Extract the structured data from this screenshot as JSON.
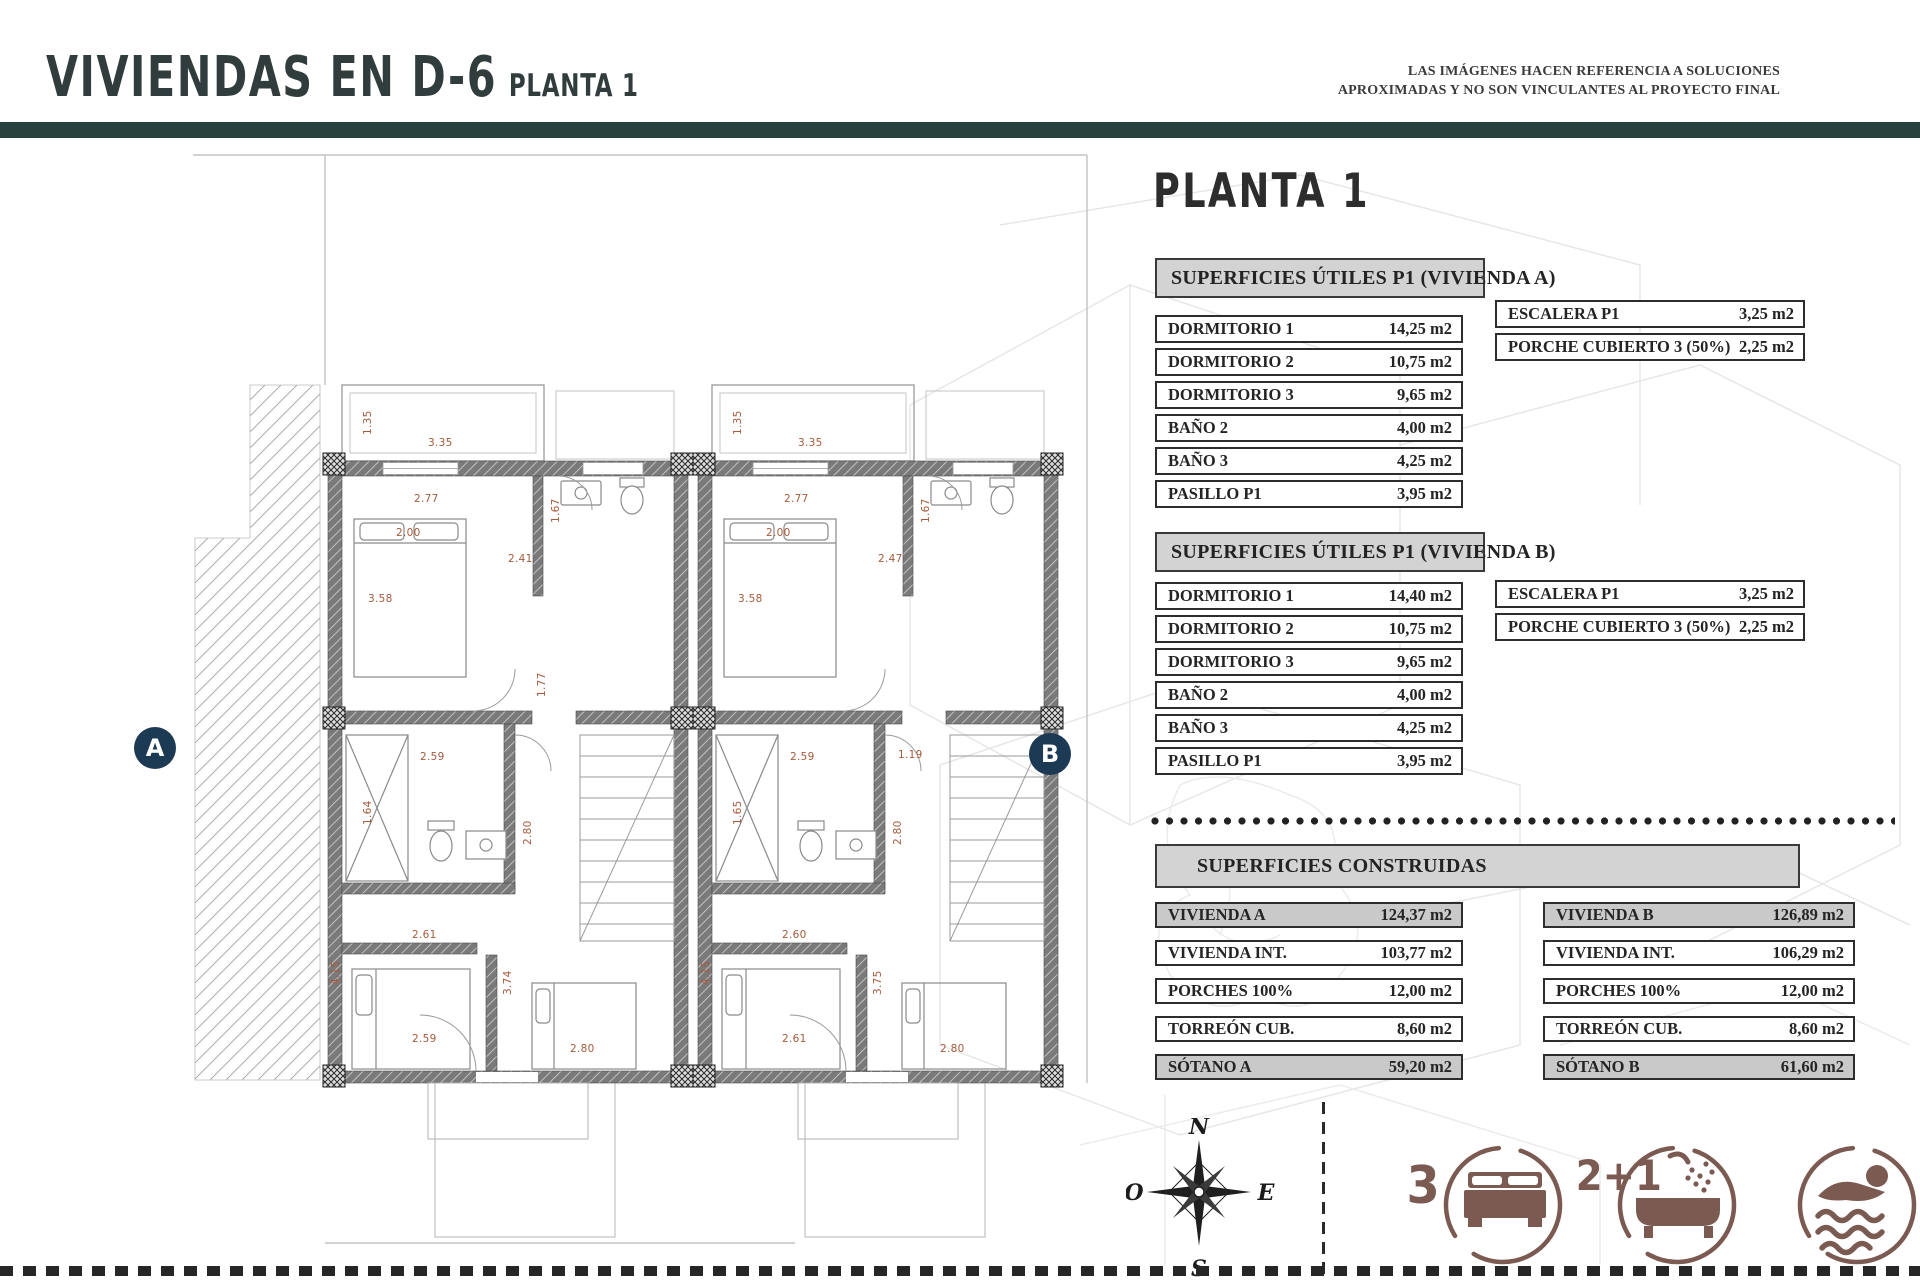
{
  "header": {
    "title": "VIVIENDAS EN D-6",
    "subtitle": "PLANTA 1",
    "disclaimer_line1": "LAS IMÁGENES HACEN REFERENCIA A SOLUCIONES",
    "disclaimer_line2": "APROXIMADAS Y NO SON VINCULANTES AL PROYECTO FINAL"
  },
  "panel": {
    "heading": "PLANTA 1",
    "utiles_a": {
      "title": "SUPERFICIES ÚTILES P1 (VIVIENDA A)",
      "rows": [
        {
          "label": "DORMITORIO 1",
          "value": "14,25 m2"
        },
        {
          "label": "DORMITORIO 2",
          "value": "10,75 m2"
        },
        {
          "label": "DORMITORIO 3",
          "value": "9,65 m2"
        },
        {
          "label": "BAÑO 2",
          "value": "4,00 m2"
        },
        {
          "label": "BAÑO 3",
          "value": "4,25 m2"
        },
        {
          "label": "PASILLO P1",
          "value": "3,95 m2"
        }
      ],
      "side_rows": [
        {
          "label": "ESCALERA P1",
          "value": "3,25 m2"
        },
        {
          "label": "PORCHE CUBIERTO 3 (50%)",
          "value": "2,25 m2"
        }
      ]
    },
    "utiles_b": {
      "title": "SUPERFICIES ÚTILES P1 (VIVIENDA B)",
      "rows": [
        {
          "label": "DORMITORIO 1",
          "value": "14,40 m2"
        },
        {
          "label": "DORMITORIO 2",
          "value": "10,75 m2"
        },
        {
          "label": "DORMITORIO 3",
          "value": "9,65 m2"
        },
        {
          "label": "BAÑO 2",
          "value": "4,00 m2"
        },
        {
          "label": "BAÑO 3",
          "value": "4,25 m2"
        },
        {
          "label": "PASILLO P1",
          "value": "3,95 m2"
        }
      ],
      "side_rows": [
        {
          "label": "ESCALERA P1",
          "value": "3,25 m2"
        },
        {
          "label": "PORCHE CUBIERTO 3 (50%)",
          "value": "2,25 m2"
        }
      ]
    },
    "construidas": {
      "title": "SUPERFICIES CONSTRUIDAS",
      "col_a": [
        {
          "label": "VIVIENDA A",
          "value": "124,37 m2",
          "shaded": true
        },
        {
          "label": "VIVIENDA INT.",
          "value": "103,77 m2"
        },
        {
          "label": "PORCHES 100%",
          "value": "12,00 m2"
        },
        {
          "label": "TORREÓN CUB.",
          "value": "8,60 m2"
        },
        {
          "label": "SÓTANO A",
          "value": "59,20 m2",
          "shaded": true
        }
      ],
      "col_b": [
        {
          "label": "VIVIENDA B",
          "value": "126,89 m2",
          "shaded": true
        },
        {
          "label": "VIVIENDA INT.",
          "value": "106,29 m2"
        },
        {
          "label": "PORCHES 100%",
          "value": "12,00 m2"
        },
        {
          "label": "TORREÓN CUB.",
          "value": "8,60 m2"
        },
        {
          "label": "SÓTANO B",
          "value": "61,60 m2",
          "shaded": true
        }
      ]
    }
  },
  "plan": {
    "badge_a": "A",
    "badge_b": "B",
    "dims_a": [
      {
        "t": "1.35",
        "x": 34,
        "y": 52,
        "v": true
      },
      {
        "t": "3.35",
        "x": 100,
        "y": 54
      },
      {
        "t": "2.77",
        "x": 86,
        "y": 110
      },
      {
        "t": "2.00",
        "x": 68,
        "y": 144
      },
      {
        "t": "3.58",
        "x": 40,
        "y": 210
      },
      {
        "t": "2.41",
        "x": 180,
        "y": 170
      },
      {
        "t": "1.67",
        "x": 222,
        "y": 140,
        "v": true
      },
      {
        "t": "1.77",
        "x": 208,
        "y": 314,
        "v": true
      },
      {
        "t": "2.59",
        "x": 92,
        "y": 368
      },
      {
        "t": "1.64",
        "x": 34,
        "y": 442,
        "v": true
      },
      {
        "t": "2.80",
        "x": 194,
        "y": 462,
        "v": true
      },
      {
        "t": "2.61",
        "x": 84,
        "y": 546
      },
      {
        "t": "4.15",
        "x": 2,
        "y": 602,
        "v": true
      },
      {
        "t": "3.74",
        "x": 174,
        "y": 612,
        "v": true
      },
      {
        "t": "2.59",
        "x": 84,
        "y": 650
      },
      {
        "t": "2.80",
        "x": 242,
        "y": 660
      }
    ],
    "dims_b": [
      {
        "t": "1.35",
        "x": 34,
        "y": 52,
        "v": true
      },
      {
        "t": "3.35",
        "x": 100,
        "y": 54
      },
      {
        "t": "2.77",
        "x": 86,
        "y": 110
      },
      {
        "t": "2.00",
        "x": 68,
        "y": 144
      },
      {
        "t": "3.58",
        "x": 40,
        "y": 210
      },
      {
        "t": "2.47",
        "x": 180,
        "y": 170
      },
      {
        "t": "1.67",
        "x": 222,
        "y": 140,
        "v": true
      },
      {
        "t": "2.59",
        "x": 92,
        "y": 368
      },
      {
        "t": "1.19",
        "x": 200,
        "y": 366
      },
      {
        "t": "1.65",
        "x": 34,
        "y": 442,
        "v": true
      },
      {
        "t": "2.80",
        "x": 194,
        "y": 462,
        "v": true
      },
      {
        "t": "2.60",
        "x": 84,
        "y": 546
      },
      {
        "t": "4.15",
        "x": 2,
        "y": 602,
        "v": true
      },
      {
        "t": "3.75",
        "x": 174,
        "y": 612,
        "v": true
      },
      {
        "t": "2.61",
        "x": 84,
        "y": 650
      },
      {
        "t": "2.80",
        "x": 242,
        "y": 660
      }
    ]
  },
  "compass": {
    "north": "N",
    "south": "S",
    "east": "E",
    "west": "O"
  },
  "features": {
    "bed_count": "3",
    "bath_count": "2+1"
  },
  "colors": {
    "accent_teal": "#27413e",
    "badge_navy": "#1d3a55",
    "icon_maroon": "#7b5a52",
    "dim_brown": "#a55a3c",
    "table_gray": "#d3d3d3"
  }
}
